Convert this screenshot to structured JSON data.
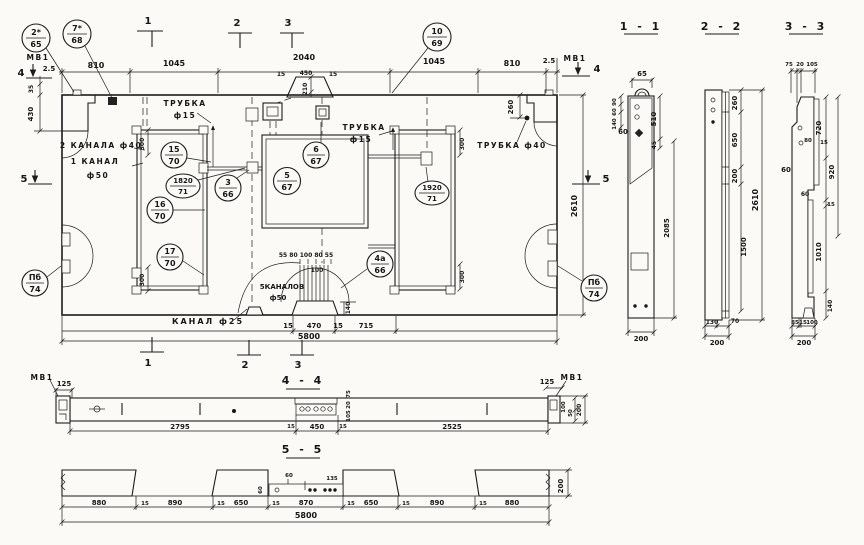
{
  "plan": {
    "marks": {
      "t1": "1",
      "t2": "2",
      "t3": "3",
      "b1": "1",
      "b2": "2",
      "b3": "3",
      "l4": "4",
      "l5": "5",
      "r4": "4",
      "r5": "5"
    },
    "dims": {
      "d810l": "810",
      "d1045l": "1045",
      "d2040": "2040",
      "d1045r": "1045",
      "d810r": "810",
      "d25l": "2.5",
      "d25r": "2.5",
      "d450": "450",
      "d15a": "15",
      "d15b": "15",
      "d210": "210",
      "d35": "35",
      "d430": "430",
      "d260": "260",
      "d2610": "2610",
      "d15c": "15",
      "d470": "470",
      "d15d": "15",
      "d715": "715",
      "d5800": "5800",
      "r300a": "300",
      "r300b": "300",
      "r300c": "300",
      "r300d": "300",
      "ch_row": "55 80 100 80 55",
      "ch100": "100",
      "ch140": "140"
    },
    "labels": {
      "mv1_left": "МВ1",
      "mv1_right": "МВ1",
      "trubka15l_1": "ТРУБКА",
      "trubka15l_2": "ф15",
      "trubka15m_1": "ТРУБКА",
      "trubka15m_2": "ф15",
      "trubka40": "ТРУБКА ф40",
      "kanala2": "2 КАНАЛА ф40",
      "kanal1_1": "1 КАНАЛ",
      "kanal1_2": "ф50",
      "kanalov5_1": "5КАНАЛОВ",
      "kanalov5_2": "ф50",
      "kanal25": "КАНАЛ ф25"
    },
    "balloons": {
      "b2s": {
        "n": "2*",
        "s": "65"
      },
      "b7s": {
        "n": "7*",
        "s": "68"
      },
      "b10": {
        "n": "10",
        "s": "69"
      },
      "b15": {
        "n": "15",
        "s": "70"
      },
      "b1820": {
        "n": "1820",
        "s": "71"
      },
      "b16": {
        "n": "16",
        "s": "70"
      },
      "b17": {
        "n": "17",
        "s": "70"
      },
      "b3": {
        "n": "3",
        "s": "66"
      },
      "b5": {
        "n": "5",
        "s": "67"
      },
      "b6": {
        "n": "6",
        "s": "67"
      },
      "b1920": {
        "n": "1920",
        "s": "71"
      },
      "b4a": {
        "n": "4а",
        "s": "66"
      },
      "bpl": {
        "n": "Пб",
        "s": "74"
      },
      "bpr": {
        "n": "Пб",
        "s": "74"
      }
    }
  },
  "sections": {
    "s11": {
      "title": "1 - 1",
      "dims": {
        "top65": "65",
        "l90": "90",
        "l60": "60",
        "l140": "140",
        "left60": "60",
        "r510": "510",
        "r45": "45",
        "r2085": "2085",
        "b200": "200"
      }
    },
    "s22": {
      "title": "2 - 2",
      "dims": {
        "r260": "260",
        "r650": "650",
        "r200": "200",
        "r1500": "1500",
        "total": "2610",
        "b130": "130",
        "b70": "70",
        "b200": "200"
      }
    },
    "s33": {
      "title": "3 - 3",
      "dims": {
        "t75": "75",
        "t20": "20",
        "t105": "105",
        "l60a": "60",
        "l60b": "60",
        "m80": "80",
        "m15": "15",
        "r720": "720",
        "r920": "920",
        "r15": "15",
        "r1010": "1010",
        "r140": "140",
        "b85": "85",
        "b15": "15",
        "b100": "100",
        "b200": "200"
      }
    },
    "s44": {
      "title": "4 - 4",
      "labels": {
        "mv1_left": "МВ1",
        "mv1_right": "МВ1"
      },
      "dims": {
        "l125": "125",
        "row2795": "2795",
        "row15a": "15",
        "row450": "450",
        "row15b": "15",
        "row2525": "2525",
        "s75": "75",
        "s20": "20",
        "s105": "105",
        "r125": "125",
        "r100": "100",
        "r50": "50",
        "r200": "200"
      }
    },
    "s55": {
      "title": "5 - 5",
      "dims": {
        "c1": "880",
        "g1": "15",
        "c2": "890",
        "g2": "15",
        "c3": "650",
        "g3": "15",
        "c4": "870",
        "g4": "15",
        "c5": "650",
        "g5": "15",
        "c6": "890",
        "g6": "15",
        "c7": "880",
        "sub60": "60",
        "sub135": "135",
        "v60": "60",
        "total": "5800",
        "r200": "200"
      }
    }
  }
}
